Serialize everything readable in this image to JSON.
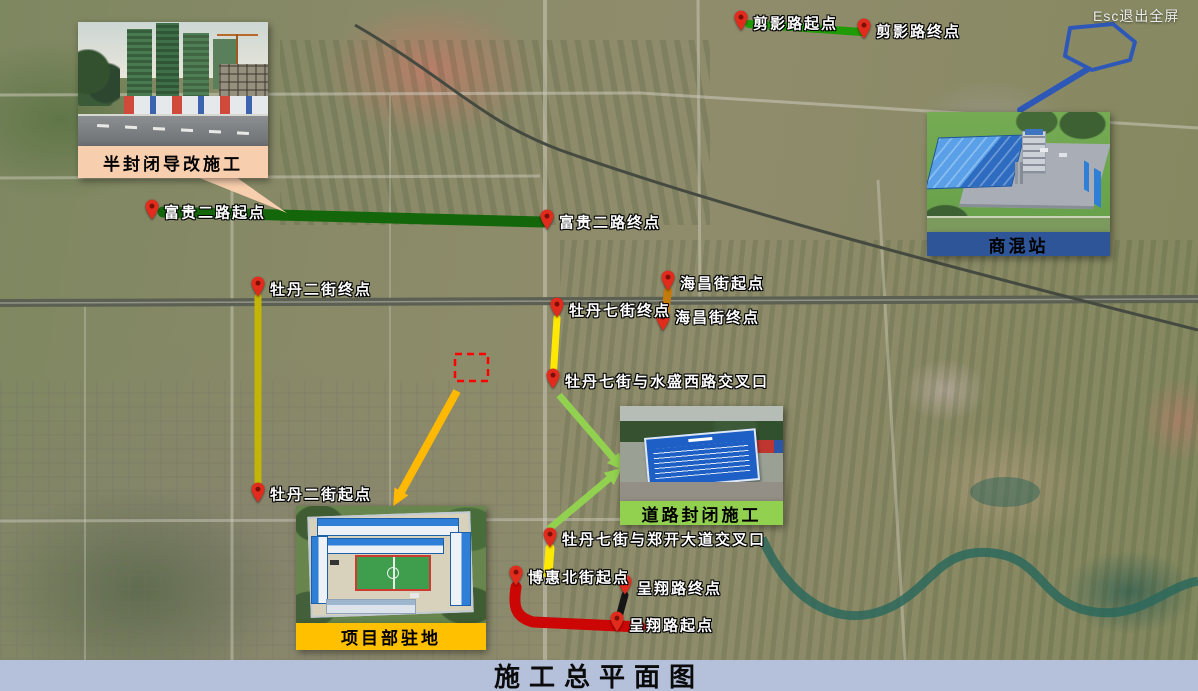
{
  "window": {
    "title": "施工总平面图",
    "fullscreen_hint": "Esc退出全屏"
  },
  "callouts": {
    "diversion": {
      "label": "半封闭导改施工"
    },
    "camp": {
      "label": "项目部驻地"
    },
    "closure": {
      "label": "道路封闭施工"
    },
    "mixing": {
      "label": "商混站"
    }
  },
  "markers": [
    {
      "id": "jianying-start",
      "label": "剪影路起点"
    },
    {
      "id": "jianying-end",
      "label": "剪影路终点"
    },
    {
      "id": "fugui-start",
      "label": "富贵二路起点"
    },
    {
      "id": "fugui-end",
      "label": "富贵二路终点"
    },
    {
      "id": "mudan2-end",
      "label": "牡丹二街终点"
    },
    {
      "id": "mudan2-start",
      "label": "牡丹二街起点"
    },
    {
      "id": "mudan7-end",
      "label": "牡丹七街终点"
    },
    {
      "id": "haichang-start",
      "label": "海昌街起点"
    },
    {
      "id": "haichang-end",
      "label": "海昌街终点"
    },
    {
      "id": "shuisheng-junction",
      "label": "牡丹七街与水盛西路交叉口"
    },
    {
      "id": "zhengkai-junction",
      "label": "牡丹七街与郑开大道交叉口"
    },
    {
      "id": "bohui-start",
      "label": "博惠北街起点"
    },
    {
      "id": "chengxiang-end",
      "label": "呈翔路终点"
    },
    {
      "id": "chengxiang-start",
      "label": "呈翔路起点"
    }
  ],
  "routes": [
    {
      "id": "jianying",
      "color": "#1f9b05"
    },
    {
      "id": "fugui",
      "color": "#14660a"
    },
    {
      "id": "mudan2",
      "color": "#c3b505"
    },
    {
      "id": "mudan7-north",
      "color": "#ffe903"
    },
    {
      "id": "haichang",
      "color": "#c47a08"
    },
    {
      "id": "mudan7-south",
      "color": "#ffe903"
    },
    {
      "id": "chengxiang",
      "color": "#151515"
    },
    {
      "id": "bohui",
      "color": "#cc0505"
    }
  ],
  "colors": {
    "pin_red": "#e02b1d",
    "arrow_green": "#92d050",
    "arrow_orange": "#ffb902",
    "callout_peach": "#f8cfae",
    "callout_gold": "#ffc000",
    "callout_green": "#92d050",
    "callout_blue_bg": "#2e5597",
    "blue_callout": "#2e58b8",
    "dashed_red": "#ff0000",
    "titlebar_bg": "#b5c0db"
  }
}
